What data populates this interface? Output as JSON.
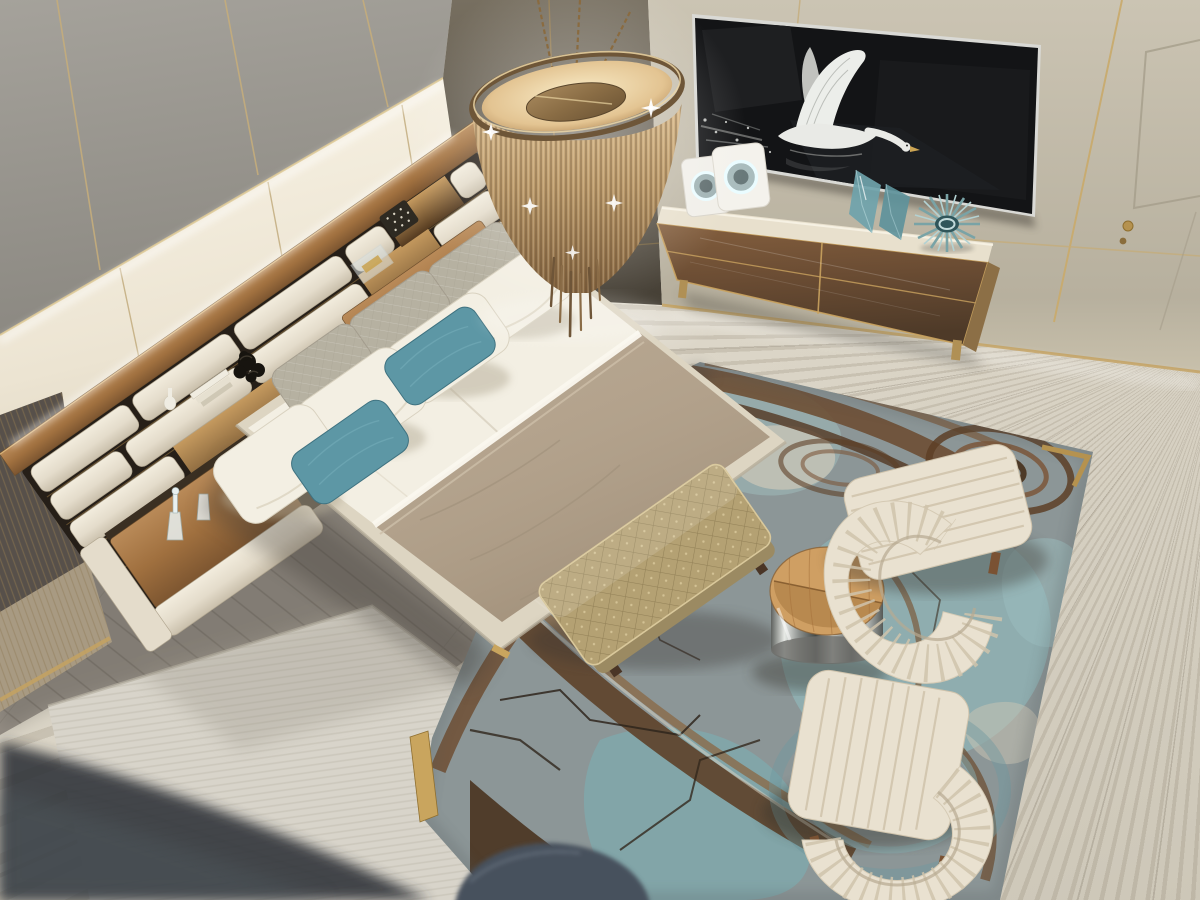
{
  "scene": {
    "title": "Luxury bedroom suite, aerial view",
    "kind": "photograph recreation",
    "description": "Top-down corner view of a designer bedroom: channel-tufted bed with teal accent pillows, chain-mail pendant chandelier, TV wall with flying-swan screen image, walnut sideboard with teal glass decor, abstract agate rug with cream armchairs, quilted bench and drum side table."
  },
  "objects": {
    "floor": "light travertine stone floor",
    "wood_floor": "grey oak plank floor beside bed",
    "light_rug": "pale striped area rug under bed",
    "wall_left": "grey fabric and cream lacquer wall panels with brass trim",
    "corner_panel": "dark bronze lacquer corner panels",
    "wall_right": "beige fabric media wall with brass seams and hidden door",
    "door_knob": "brass door knob",
    "tv": "wall TV showing a flying swan over water",
    "sideboard": "walnut media sideboard with marble top",
    "ring_sculpture": "white back-lit ring sculpture",
    "glass_vases": "faceted teal glass vases",
    "sunburst": "teal sunburst bowl sculpture",
    "chandelier": "champagne chain-mail pendant chandelier",
    "headboard": "woven cream upholstered headboard with walnut shelf and lit niches",
    "nightstand": "integrated walnut nightstand with glass decanters",
    "tray": "walnut side tray with brass bird figurine",
    "bed": "platform bed with white linens and taupe velvet throw",
    "pillows": "cream, silver-grey and teal pillows",
    "bench": "champagne quilted foot bench",
    "rug": "abstract agate rug in teal, slate and bronze with brass corner inlays",
    "side_table": "split oak-top drum table on polished steel base",
    "armchair_upper": "cream channel-tufted armchair (by window side)",
    "armchair_lower": "cream channel-tufted armchair (foreground)",
    "pouf": "denim-blue pouf entering frame",
    "decor_items": "black knot sculpture, books, vase, woven box, glass box"
  },
  "palette": {
    "travertine": "#d9d3c5",
    "wood_floor": "#968f86",
    "light_rug": "#d8d4ca",
    "rug_slate": "#8c9697",
    "rug_teal": "#8fb2b3",
    "rug_teal_deep": "#7fa9ad",
    "rug_brown": "#6b4a2e",
    "rug_brown_dark": "#49331f",
    "rug_cream": "#cdc8b8",
    "bench_gold": "#b4a173",
    "chair_cream": "#e9e1d0",
    "sheet_white": "#f3efe3",
    "blanket_taupe": "#b5a48e",
    "bed_wrap": "#ddd5c2",
    "rail_cream": "#e9e2d2",
    "teal_pillow": "#5d97a5",
    "gray_pillow": "#b6b1a1",
    "tv_black": "#0a0b0d",
    "marble_top": "#e8e0cd",
    "wall_gray": "#9b9892",
    "wall_cream": "#efe9da",
    "wall_beige": "#c3bcab",
    "panel_dark": "#5f584c",
    "gold": "#b5924f",
    "teal_glass": "#6fa3ab",
    "champagne": "#c2a276",
    "navy_pouf": "#46505c",
    "swan_white": "#e9eae5"
  }
}
